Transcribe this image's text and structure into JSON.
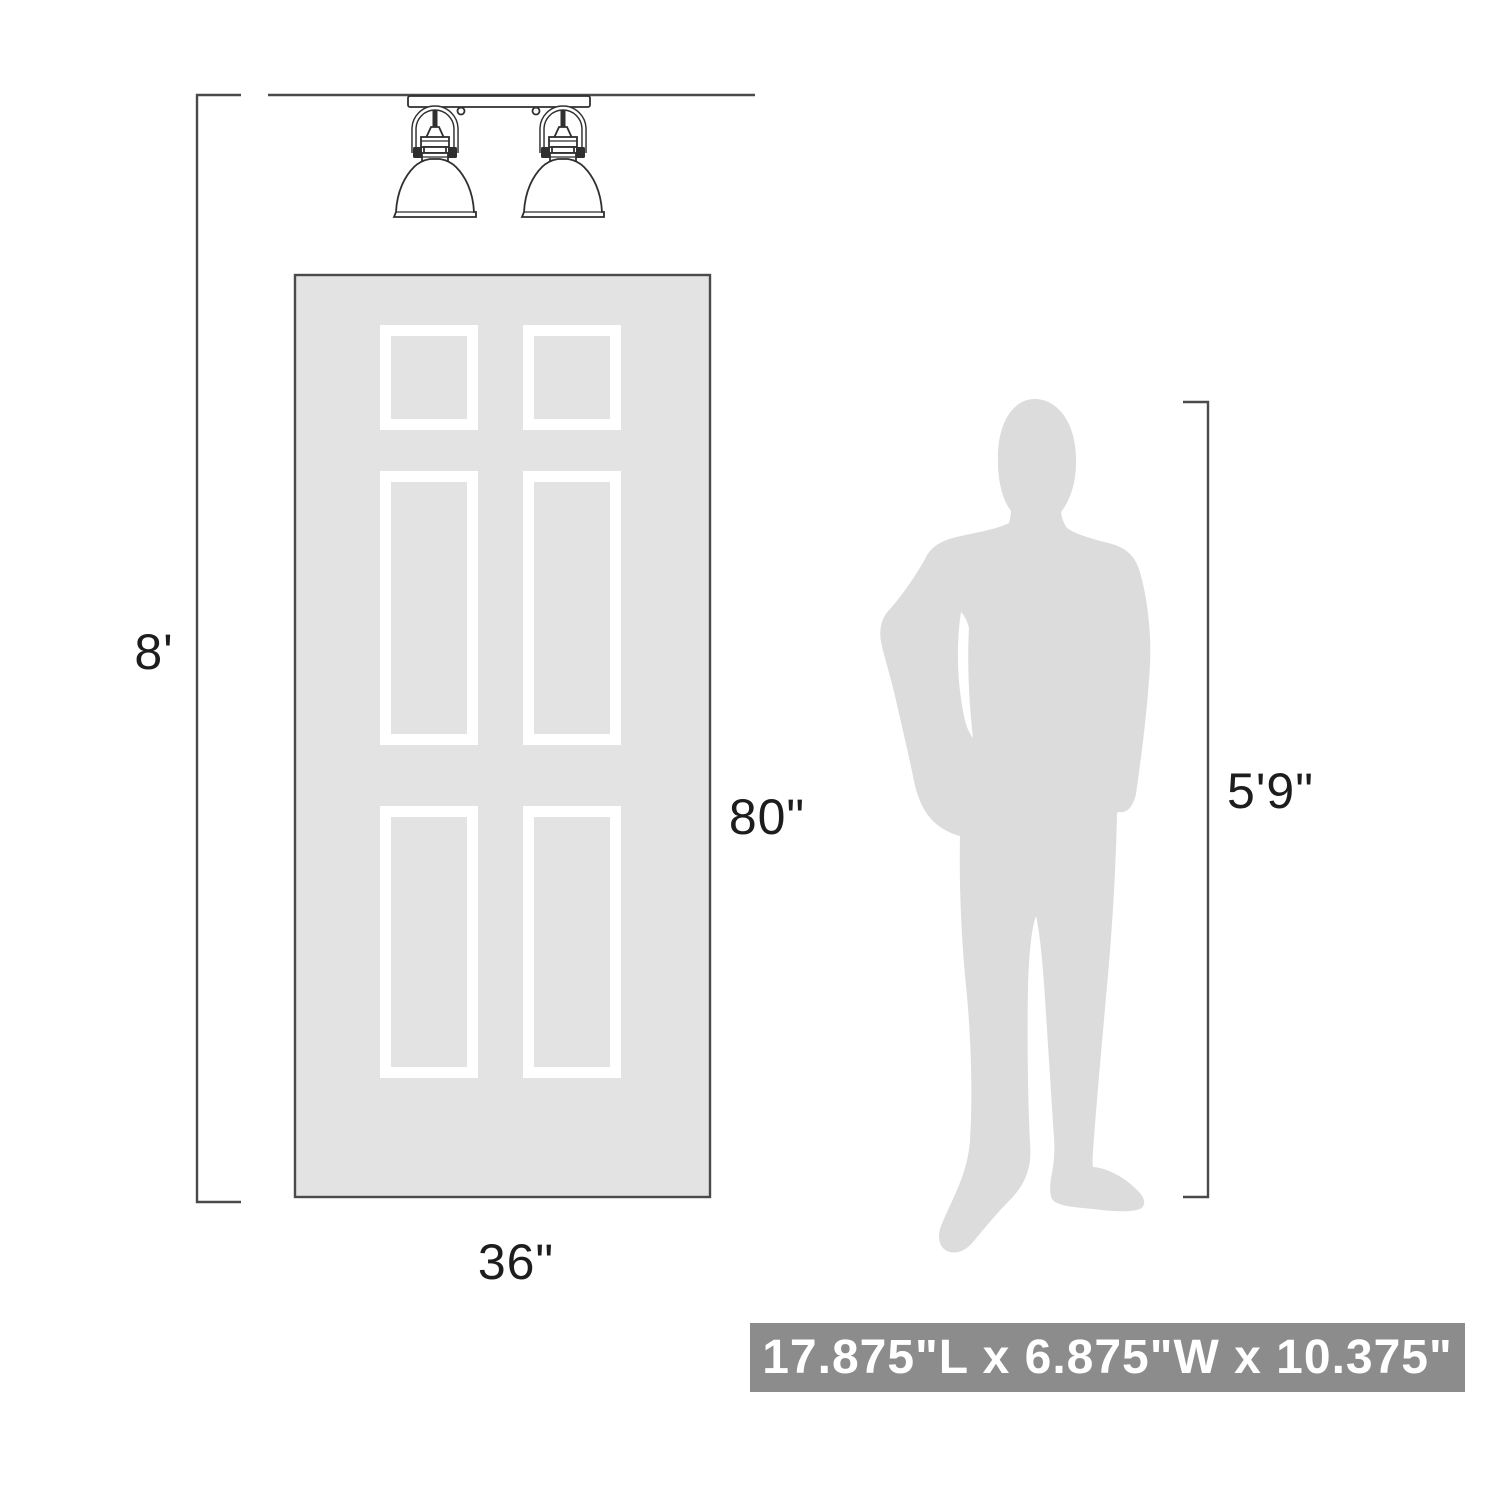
{
  "diagram": {
    "labels": {
      "ceiling_height": "8'",
      "door_height": "80\"",
      "door_width": "36\"",
      "person_height": "5'9\""
    },
    "dimension_bar": {
      "text": "17.875\"L x 6.875\"W x 10.375\""
    },
    "colors": {
      "line": "#4a4a4a",
      "outline": "#2f2f2f",
      "door_fill": "#e3e3e3",
      "panel_frame": "#ffffff",
      "silhouette_fill": "#dcdcdc",
      "dimension_bar_bg": "#8c8c8c",
      "dimension_bar_text": "#ffffff",
      "label_text": "#1d1d1d",
      "page_bg": "#ffffff"
    }
  }
}
